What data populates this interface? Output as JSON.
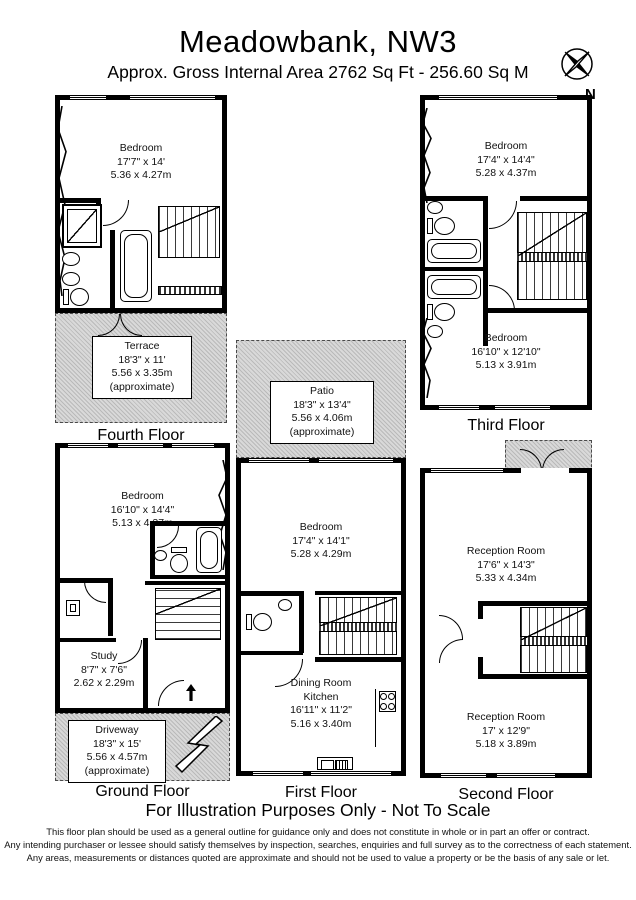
{
  "header": {
    "title": "Meadowbank, NW3",
    "subtitle": "Approx. Gross Internal Area  2762 Sq Ft  -  256.60 Sq M",
    "compass": "N"
  },
  "floors": {
    "fourth": {
      "label": "Fourth Floor",
      "bedroom": {
        "name": "Bedroom",
        "imperial": "17'7\" x 14'",
        "metric": "5.36 x 4.27m"
      },
      "terrace": {
        "name": "Terrace",
        "imperial": "18'3\" x 11'",
        "metric": "5.56 x 3.35m",
        "note": "(approximate)"
      }
    },
    "third": {
      "label": "Third Floor",
      "bedroom_front": {
        "name": "Bedroom",
        "imperial": "17'4\" x 14'4\"",
        "metric": "5.28 x 4.37m"
      },
      "bedroom_back": {
        "name": "Bedroom",
        "imperial": "16'10\" x 12'10\"",
        "metric": "5.13 x 3.91m"
      }
    },
    "ground": {
      "label": "Ground Floor",
      "bedroom": {
        "name": "Bedroom",
        "imperial": "16'10\" x 14'4\"",
        "metric": "5.13 x 4.37m"
      },
      "study": {
        "name": "Study",
        "imperial": "8'7\" x 7'6\"",
        "metric": "2.62 x 2.29m"
      },
      "driveway": {
        "name": "Driveway",
        "imperial": "18'3\" x 15'",
        "metric": "5.56 x 4.57m",
        "note": "(approximate)"
      }
    },
    "first": {
      "label": "First Floor",
      "patio": {
        "name": "Patio",
        "imperial": "18'3\" x 13'4\"",
        "metric": "5.56 x 4.06m",
        "note": "(approximate)"
      },
      "bedroom": {
        "name": "Bedroom",
        "imperial": "17'4\" x 14'1\"",
        "metric": "5.28 x 4.29m"
      },
      "dining_kitchen": {
        "name": "Dining Room",
        "name2": "Kitchen",
        "imperial": "16'11\" x 11'2\"",
        "metric": "5.16 x 3.40m"
      }
    },
    "second": {
      "label": "Second Floor",
      "reception_front": {
        "name": "Reception Room",
        "imperial": "17'6\" x 14'3\"",
        "metric": "5.33 x 4.34m"
      },
      "reception_back": {
        "name": "Reception Room",
        "imperial": "17' x 12'9\"",
        "metric": "5.18 x 3.89m"
      }
    }
  },
  "footer": {
    "heading": "For Illustration Purposes Only - Not To Scale",
    "line1": "This floor plan should be used as a general outline for guidance only and does not constitute in whole or in part an offer or contract.",
    "line2": "Any intending purchaser or lessee should satisfy themselves by inspection, searches, enquiries and full survey as to the correctness of each statement.",
    "line3": "Any areas, measurements or distances quoted are approximate and should not be used to value a property or be the basis of any sale or let."
  }
}
